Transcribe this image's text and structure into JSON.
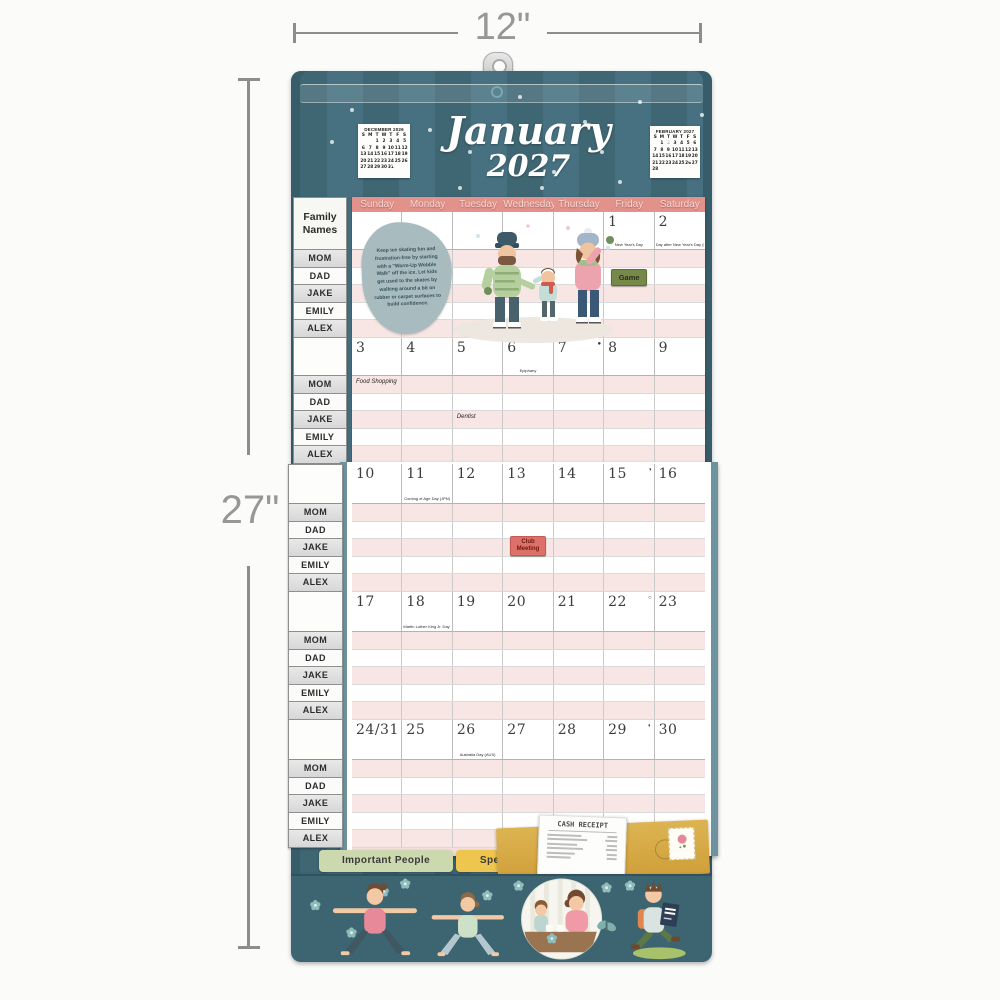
{
  "meta": {
    "width_label": "12\"",
    "height_label": "27\""
  },
  "header": {
    "month": "January",
    "year": "2027",
    "mini_calendars": [
      {
        "title": "DECEMBER 2026",
        "dow": [
          "S",
          "M",
          "T",
          "W",
          "T",
          "F",
          "S"
        ],
        "cells": [
          "",
          "",
          "1",
          "2",
          "3",
          "4",
          "5",
          "6",
          "7",
          "8",
          "9",
          "10",
          "11",
          "12",
          "13",
          "14",
          "15",
          "16",
          "17",
          "18",
          "19",
          "20",
          "21",
          "22",
          "23",
          "24",
          "25",
          "26",
          "27",
          "28",
          "29",
          "30",
          "31",
          "",
          ""
        ]
      },
      {
        "title": "FEBRUARY 2027",
        "dow": [
          "S",
          "M",
          "T",
          "W",
          "T",
          "F",
          "S"
        ],
        "cells": [
          "",
          "1",
          "2",
          "3",
          "4",
          "5",
          "6",
          "7",
          "8",
          "9",
          "10",
          "11",
          "12",
          "13",
          "14",
          "15",
          "16",
          "17",
          "18",
          "19",
          "20",
          "21",
          "22",
          "23",
          "24",
          "25",
          "26",
          "27",
          "28",
          "",
          "",
          "",
          "",
          "",
          ""
        ]
      }
    ]
  },
  "weekday_headers": [
    "Sunday",
    "Monday",
    "Tuesday",
    "Wednesday",
    "Thursday",
    "Friday",
    "Saturday"
  ],
  "sidebar": {
    "header": "Family Names",
    "names": [
      "MOM",
      "DAD",
      "JAKE",
      "EMILY",
      "ALEX"
    ]
  },
  "weeks": [
    {
      "page": "top",
      "days": [
        {},
        {},
        {},
        {},
        {},
        {
          "d": "1",
          "holiday": "New Year's Day"
        },
        {
          "d": "2",
          "holiday": "Day after New Year's Day (NZ)"
        }
      ]
    },
    {
      "page": "top",
      "days": [
        {
          "d": "3"
        },
        {
          "d": "4"
        },
        {
          "d": "5"
        },
        {
          "d": "6",
          "holiday": "Epiphany"
        },
        {
          "d": "7",
          "moon": "●"
        },
        {
          "d": "8"
        },
        {
          "d": "9"
        }
      ]
    },
    {
      "page": "bottom",
      "days": [
        {
          "d": "10"
        },
        {
          "d": "11",
          "holiday": "Coming of Age Day (JPN)"
        },
        {
          "d": "12"
        },
        {
          "d": "13"
        },
        {
          "d": "14"
        },
        {
          "d": "15",
          "moon": "◑"
        },
        {
          "d": "16"
        }
      ]
    },
    {
      "page": "bottom",
      "days": [
        {
          "d": "17"
        },
        {
          "d": "18",
          "holiday": "Martin Luther King Jr. Day (US)"
        },
        {
          "d": "19"
        },
        {
          "d": "20"
        },
        {
          "d": "21"
        },
        {
          "d": "22",
          "moon": "○"
        },
        {
          "d": "23"
        }
      ]
    },
    {
      "page": "bottom",
      "days": [
        {
          "d": "24/31"
        },
        {
          "d": "25"
        },
        {
          "d": "26",
          "holiday": "Australia Day (AUS)"
        },
        {
          "d": "27"
        },
        {
          "d": "28"
        },
        {
          "d": "29",
          "moon": "◐"
        },
        {
          "d": "30"
        }
      ]
    }
  ],
  "entries": {
    "handwritten": [
      {
        "week": 1,
        "col": 0,
        "row": 0,
        "text": "Food Shopping"
      },
      {
        "week": 1,
        "col": 2,
        "row": 2,
        "text": "Dentist"
      }
    ],
    "stickers": [
      {
        "week": 0,
        "col": 5,
        "row": 1,
        "label": "Game",
        "color": "green"
      },
      {
        "week": 2,
        "col": 3,
        "row": 2,
        "label": "Club Meeting",
        "color": "red"
      }
    ]
  },
  "tip_note": "Keep ice skating fun and frustration-free by starting with a \"Warm-Up Wobble Walk\" off the ice. Let kids get used to the skates by walking around a bit on rubber or carpet surfaces to build confidence.",
  "pocket": {
    "tabs": [
      {
        "label": "Important People",
        "color": "#ccd8ae"
      },
      {
        "label": "Special Dates",
        "color": "#eec54e"
      }
    ],
    "receipt_title": "CASH RECEIPT"
  },
  "colors": {
    "board_teal": "#3f6673",
    "header_salmon": "#e2918b",
    "row_pink": "#f8e6e4",
    "sticker_green": "#76894a",
    "sticker_red": "#dd7168",
    "envelope_gold": "#cf9f3a",
    "pocket_band": "#3c6471",
    "dimension_gray": "#8d8d8d"
  }
}
